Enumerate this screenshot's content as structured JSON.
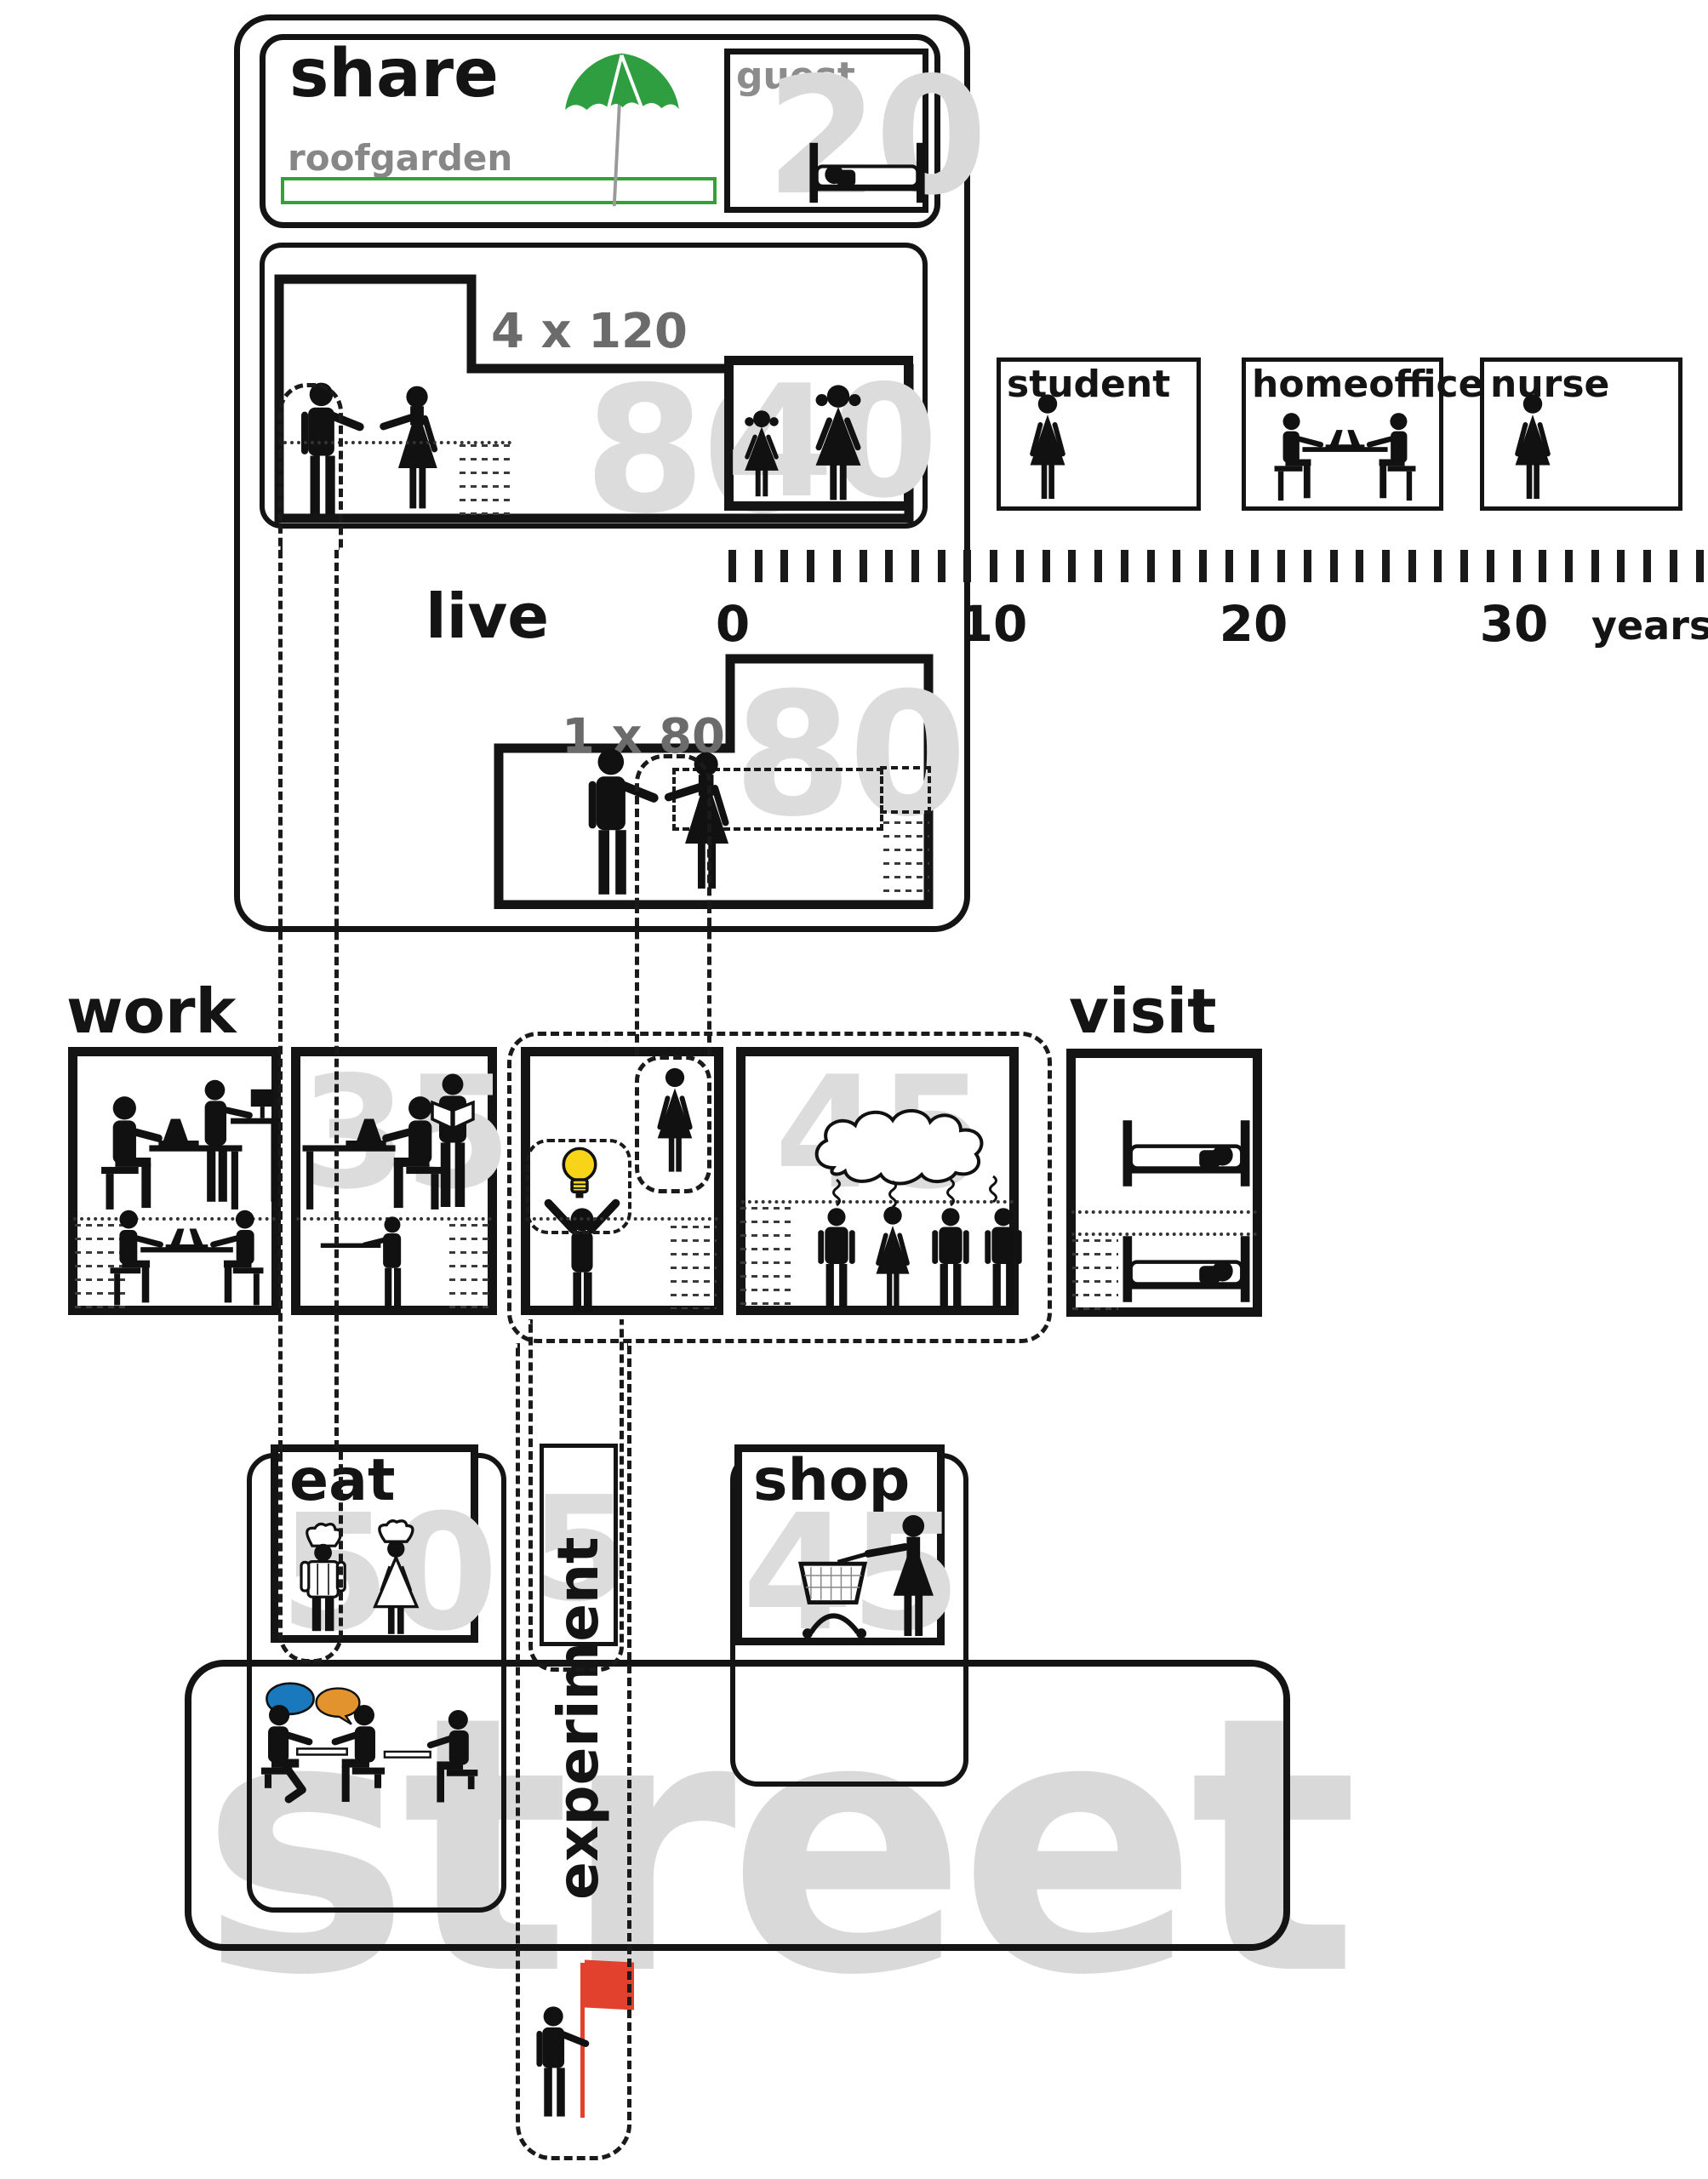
{
  "share": {
    "title": "share",
    "roofgarden_label": "roofgarden",
    "guest_label": "guest",
    "guest_value": "20"
  },
  "live": {
    "title": "live",
    "large_label": "4 x 120",
    "large_value": "80",
    "kids_value": "40",
    "small_label": "1 x 80",
    "small_value": "80"
  },
  "residents": [
    {
      "label": "student"
    },
    {
      "label": "homeoffice"
    },
    {
      "label": "nurse"
    }
  ],
  "timeline": {
    "tick_count": 38,
    "labels": [
      "0",
      "10",
      "20",
      "30"
    ],
    "unit": "years"
  },
  "work": {
    "title": "work",
    "value_left": "35",
    "value_right": "45"
  },
  "visit": {
    "title": "visit"
  },
  "eat": {
    "title": "eat",
    "value": "50"
  },
  "experiment": {
    "title": "experiment",
    "value": "5"
  },
  "shop": {
    "title": "shop",
    "value": "45"
  },
  "street": {
    "title": "street"
  },
  "colors": {
    "accent_green": "#33a038",
    "bulb_yellow": "#f7d417",
    "flag_red": "#e2422d",
    "bubble_blue": "#1a79bd",
    "bubble_orange": "#e2932d",
    "ghost_gray": "#dcdcdc",
    "label_gray": "#6b6b6b"
  }
}
